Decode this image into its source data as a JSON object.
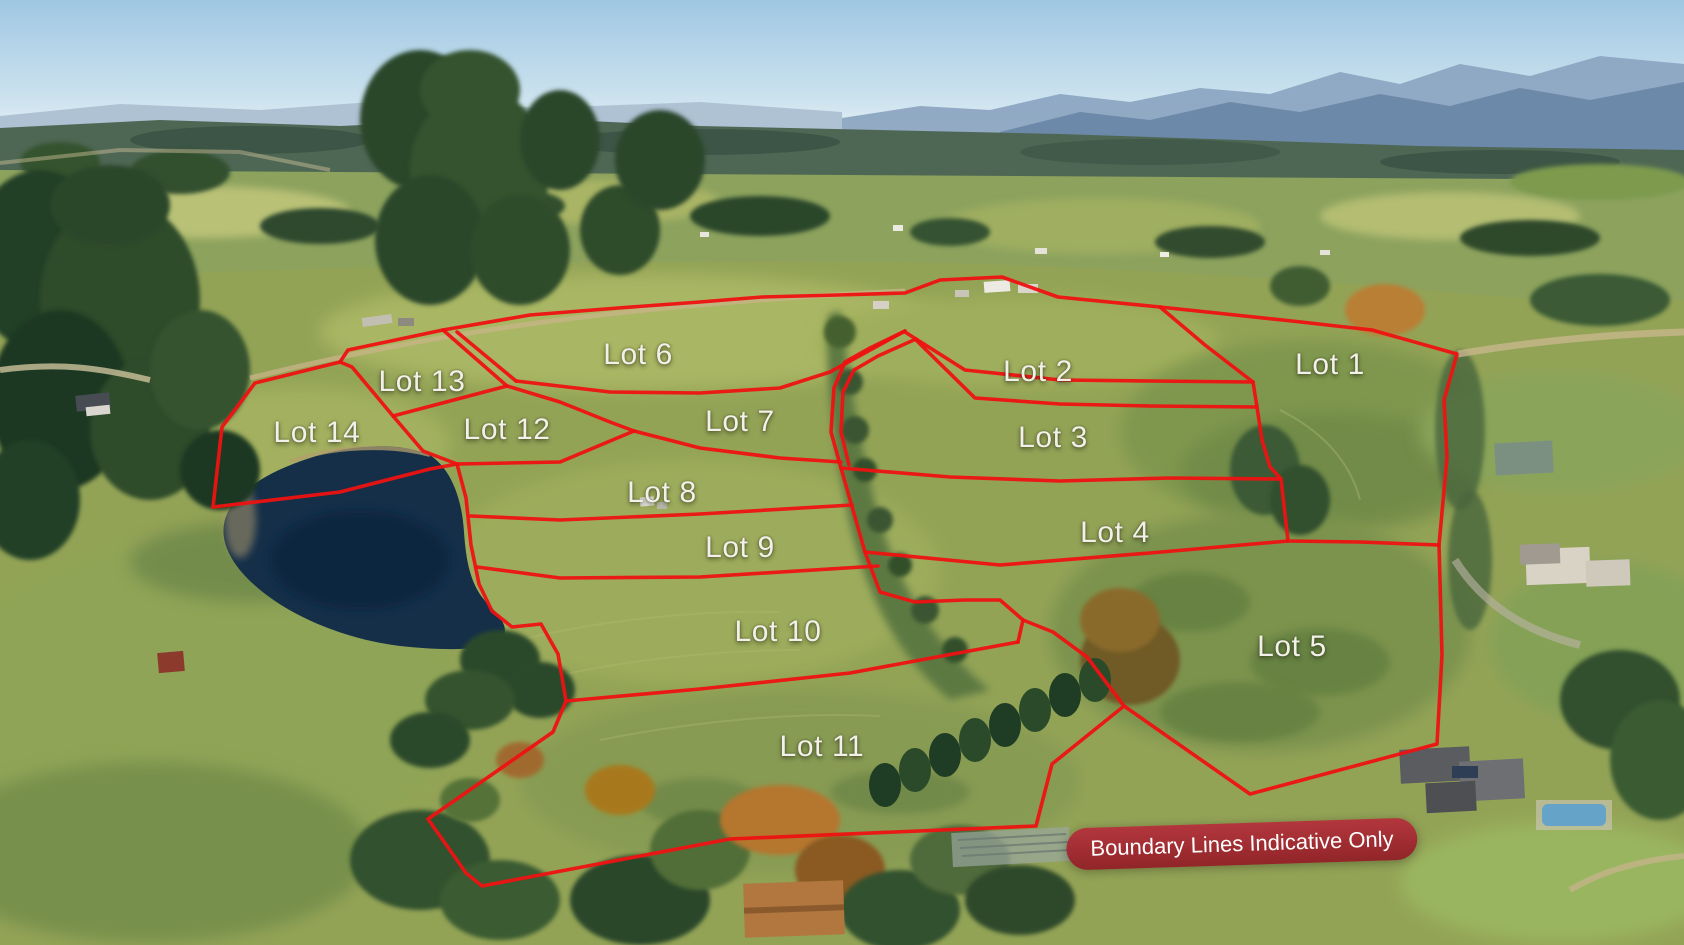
{
  "overlay": {
    "disclaimer": "Boundary Lines Indicative Only"
  },
  "lots": [
    {
      "id": "lot-1",
      "label": "Lot 1",
      "x_pct": 78.98,
      "y_pct": 38.62
    },
    {
      "id": "lot-2",
      "label": "Lot 2",
      "x_pct": 61.64,
      "y_pct": 39.37
    },
    {
      "id": "lot-3",
      "label": "Lot 3",
      "x_pct": 62.53,
      "y_pct": 46.35
    },
    {
      "id": "lot-4",
      "label": "Lot 4",
      "x_pct": 66.21,
      "y_pct": 56.4
    },
    {
      "id": "lot-5",
      "label": "Lot 5",
      "x_pct": 76.72,
      "y_pct": 68.47
    },
    {
      "id": "lot-6",
      "label": "Lot 6",
      "x_pct": 37.89,
      "y_pct": 37.57
    },
    {
      "id": "lot-7",
      "label": "Lot 7",
      "x_pct": 43.94,
      "y_pct": 44.66
    },
    {
      "id": "lot-8",
      "label": "Lot 8",
      "x_pct": 39.31,
      "y_pct": 52.17
    },
    {
      "id": "lot-9",
      "label": "Lot 9",
      "x_pct": 43.94,
      "y_pct": 57.99
    },
    {
      "id": "lot-10",
      "label": "Lot 10",
      "x_pct": 46.2,
      "y_pct": 66.88
    },
    {
      "id": "lot-11",
      "label": "Lot 11",
      "x_pct": 48.81,
      "y_pct": 79.05
    },
    {
      "id": "lot-12",
      "label": "Lot 12",
      "x_pct": 30.11,
      "y_pct": 45.5
    },
    {
      "id": "lot-13",
      "label": "Lot 13",
      "x_pct": 25.06,
      "y_pct": 40.42
    },
    {
      "id": "lot-14",
      "label": "Lot 14",
      "x_pct": 18.82,
      "y_pct": 45.82
    }
  ],
  "colors": {
    "boundary_red": "#ee1212",
    "badge_bg": "#9c2430",
    "label_text": "#f3f0e9",
    "sky_top": "#9fc7e2",
    "pond": "#152f49",
    "pasture": "#93a356"
  },
  "scene": {
    "features": [
      "sky",
      "mountain-range",
      "forest-hills",
      "countryside",
      "pasture",
      "pond",
      "gully-trees",
      "shelterbelt",
      "estate-house",
      "pool-house",
      "barn",
      "farm-road"
    ]
  }
}
